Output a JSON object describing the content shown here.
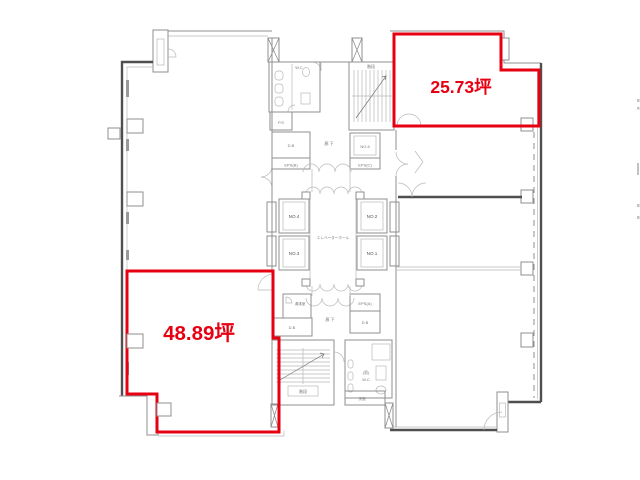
{
  "drawing": {
    "kind": "office-building-floor-plan",
    "colors": {
      "highlight_red": "#e60012",
      "wall_dark": "#4f4f4f",
      "wall_gray": "#8f8f8f"
    }
  },
  "units": {
    "top_right": {
      "area_label": "25.73坪"
    },
    "bottom_left": {
      "area_label": "48.89坪"
    }
  },
  "core": {
    "elevator_hall_label": "エレベーターホール",
    "elevators": {
      "no1": "NO.1",
      "no2": "NO.2",
      "no3": "NO.3",
      "no4": "NO.4",
      "no5": "NO.5"
    },
    "corridor_top": "廊 下",
    "corridor_bottom": "廊 下",
    "stairs_top": "階段",
    "stairs_bottom": "階段",
    "wc_top": "W.C",
    "wc_bottom_line1": "(男)",
    "wc_bottom_line2": "W.C",
    "rooms": {
      "ps": "P.S",
      "db_mid": "D.B",
      "db_bottom_left": "D.B",
      "db_bottom_right": "D.B",
      "eps_a": "EPS(A)",
      "eps_b": "EPS(B)",
      "eps_c": "EPS(C)",
      "yuwakashi": "湯沸室",
      "senmen": "洗面"
    }
  }
}
